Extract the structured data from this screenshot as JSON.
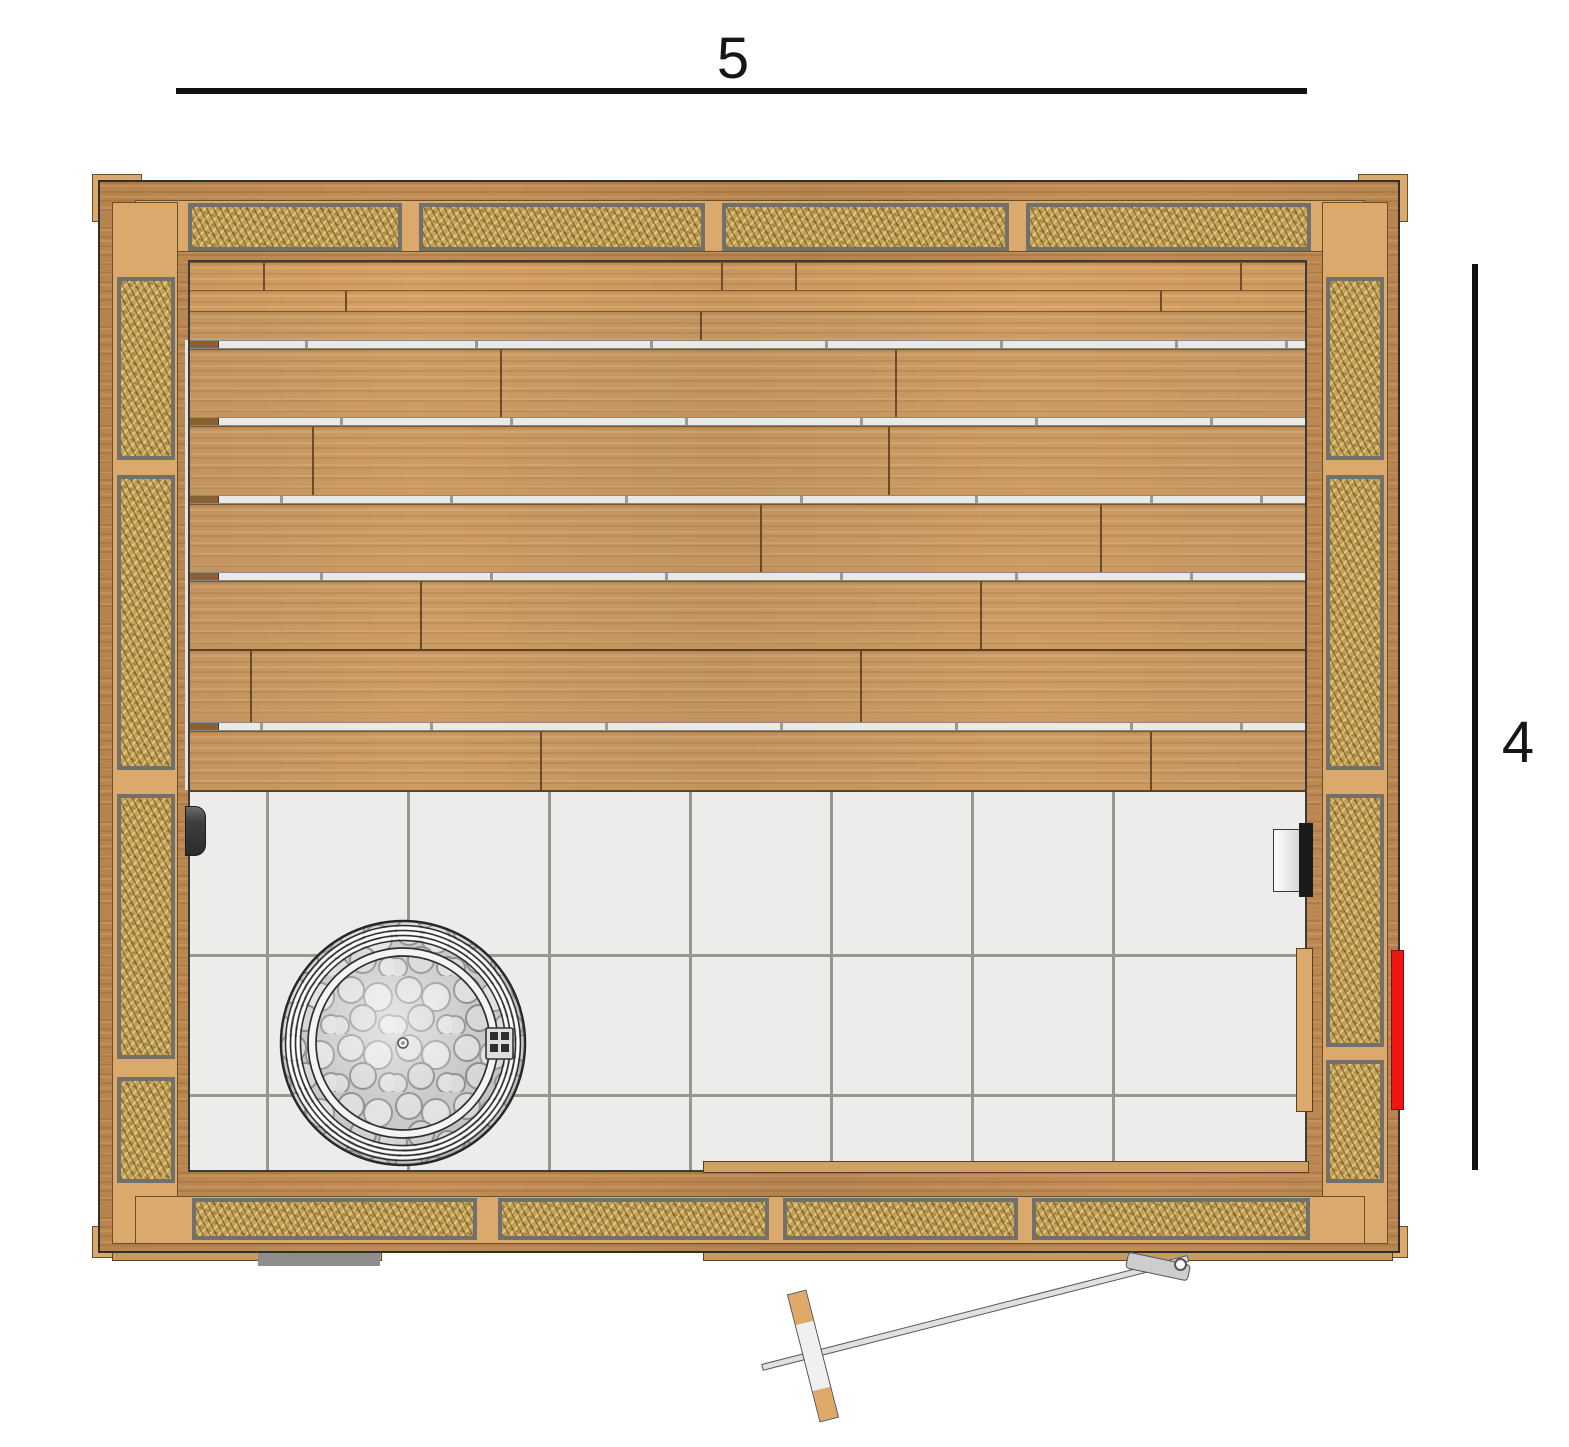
{
  "title": "Sauna floor plan (top view)",
  "dimensions": {
    "width": {
      "label": "5"
    },
    "height": {
      "label": "4"
    }
  },
  "colors": {
    "wood": "#c28c55",
    "bench_wood": "#cd9c64",
    "frame_tan": "#dca96c",
    "insulation_fill": "#c5a258",
    "insulation_border": "#73706a",
    "tile": "#ecedeb",
    "grout": "#97978f",
    "stone_grey": "#dcdcdc",
    "accent_red": "#ee1512",
    "dimension_line": "#111111"
  },
  "elements": {
    "heater": "round-stone-heater",
    "door": "glass-door-swung-open",
    "door_handle": "wood-capped-handle-bar",
    "left_fixture": "door-handle-black",
    "right_fixture": "wall-vent-cylinder",
    "red_fixture": "heater-control-unit",
    "mat": "grey-floor-mat"
  }
}
